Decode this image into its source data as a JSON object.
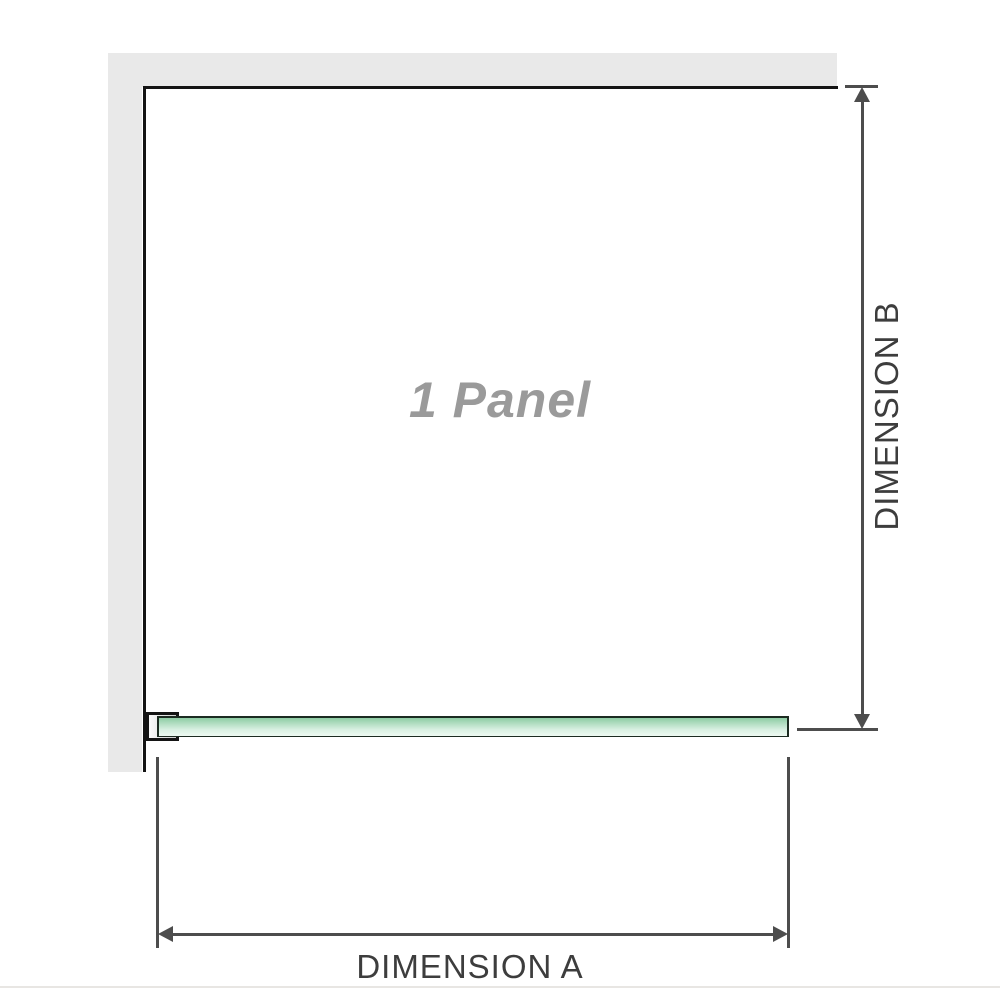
{
  "labels": {
    "panel": "1 Panel",
    "dimension_a": "DIMENSION A",
    "dimension_b": "DIMENSION B"
  },
  "colors": {
    "wall": "#e9e9e9",
    "outline": "#141414",
    "dimension": "#4d4d4d",
    "label_text": "#3d3d3d",
    "panel_text": "#9a9a9a",
    "glass_top": "#8ecda4",
    "glass_mid": "#d9f0e2",
    "glass_bottom": "#eef9f2",
    "glass_border": "#1c2b21",
    "bracket_fill_light": "#fbfbfb",
    "bracket_fill_dark": "#cfcfcf",
    "divider": "#e8e6e3"
  }
}
